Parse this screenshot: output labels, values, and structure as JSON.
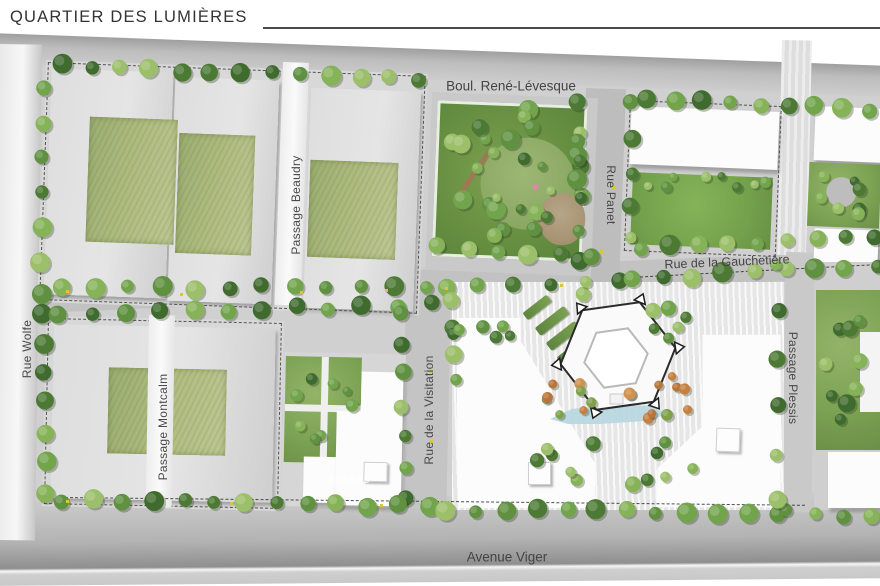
{
  "title": "QUARTIER DES LUMIÈRES",
  "map": {
    "streets": {
      "rene_levesque": {
        "label": "Boul. René-Lévesque"
      },
      "viger": {
        "label": "Avenue Viger"
      },
      "wolfe": {
        "label": "Rue Wolfe"
      },
      "panet": {
        "label": "Rue Panet"
      },
      "gauchetiere": {
        "label": "Rue de la Gauchetière"
      },
      "beaudry": {
        "label": "Passage Beaudry"
      },
      "montcalm": {
        "label": "Passage Montcalm"
      },
      "visitation": {
        "label": "Rue de la Visitation"
      },
      "plessis": {
        "label": "Passage Plessis"
      }
    },
    "building_note": "ÉTAGES",
    "colors": {
      "road_band": "#b0b0b0",
      "sidewalk": "#d0d0d0",
      "green_roof": "#aebb7f",
      "lawn": "#74a24c",
      "park": "#6f9449",
      "water": "#b9d8e1",
      "autumn_tree": "#c9853f",
      "building_white": "#fcfcfc",
      "label_text": "#4a4a4a"
    },
    "tree_palette_green": [
      "#4c7a35",
      "#5f9140",
      "#72a44c",
      "#86b258",
      "#3f6b2e",
      "#9cbf6a"
    ],
    "tree_palette_orange": [
      "#c5803f",
      "#d1924f",
      "#b9743a",
      "#7fa14c"
    ],
    "tree_rows": [
      {
        "x1": 60,
        "y1": 66,
        "x2": 420,
        "y2": 80,
        "n": 13,
        "r": 8,
        "p": "g"
      },
      {
        "x1": 42,
        "y1": 88,
        "x2": 42,
        "y2": 295,
        "n": 7,
        "r": 8,
        "p": "g"
      },
      {
        "x1": 44,
        "y1": 312,
        "x2": 46,
        "y2": 492,
        "n": 7,
        "r": 8,
        "p": "g"
      },
      {
        "x1": 578,
        "y1": 102,
        "x2": 582,
        "y2": 292,
        "n": 7,
        "r": 7,
        "p": "g"
      },
      {
        "x1": 630,
        "y1": 104,
        "x2": 632,
        "y2": 240,
        "n": 5,
        "r": 7,
        "p": "g"
      },
      {
        "x1": 648,
        "y1": 100,
        "x2": 872,
        "y2": 110,
        "n": 9,
        "r": 8,
        "p": "g"
      },
      {
        "x1": 62,
        "y1": 289,
        "x2": 428,
        "y2": 286,
        "n": 12,
        "r": 8,
        "p": "g"
      },
      {
        "x1": 60,
        "y1": 313,
        "x2": 430,
        "y2": 305,
        "n": 12,
        "r": 8,
        "p": "g"
      },
      {
        "x1": 445,
        "y1": 288,
        "x2": 618,
        "y2": 282,
        "n": 6,
        "r": 7,
        "p": "g"
      },
      {
        "x1": 640,
        "y1": 248,
        "x2": 876,
        "y2": 237,
        "n": 9,
        "r": 8,
        "p": "g"
      },
      {
        "x1": 632,
        "y1": 280,
        "x2": 876,
        "y2": 265,
        "n": 9,
        "r": 8,
        "p": "g"
      },
      {
        "x1": 402,
        "y1": 312,
        "x2": 404,
        "y2": 498,
        "n": 7,
        "r": 7,
        "p": "g"
      },
      {
        "x1": 453,
        "y1": 300,
        "x2": 455,
        "y2": 380,
        "n": 4,
        "r": 7,
        "p": "g"
      },
      {
        "x1": 62,
        "y1": 500,
        "x2": 428,
        "y2": 506,
        "n": 13,
        "r": 8,
        "p": "g"
      },
      {
        "x1": 446,
        "y1": 509,
        "x2": 778,
        "y2": 514,
        "n": 12,
        "r": 8,
        "p": "g"
      },
      {
        "x1": 788,
        "y1": 512,
        "x2": 872,
        "y2": 516,
        "n": 4,
        "r": 7,
        "p": "g"
      },
      {
        "x1": 777,
        "y1": 265,
        "x2": 778,
        "y2": 500,
        "n": 6,
        "r": 7,
        "p": "g"
      },
      {
        "x1": 436,
        "y1": 247,
        "x2": 592,
        "y2": 256,
        "n": 6,
        "r": 8,
        "p": "g"
      }
    ],
    "tree_clusters": [
      {
        "cx": 516,
        "cy": 176,
        "rx": 70,
        "ry": 66,
        "n": 22,
        "rmin": 5,
        "rmax": 10,
        "p": "g"
      },
      {
        "cx": 520,
        "cy": 180,
        "rx": 40,
        "ry": 38,
        "n": 6,
        "rmin": 4,
        "rmax": 7,
        "p": "g"
      },
      {
        "cx": 706,
        "cy": 182,
        "rx": 62,
        "ry": 9,
        "n": 8,
        "rmin": 4,
        "rmax": 6,
        "p": "g"
      },
      {
        "cx": 845,
        "cy": 195,
        "rx": 28,
        "ry": 26,
        "n": 7,
        "rmin": 4,
        "rmax": 7,
        "p": "g"
      },
      {
        "cx": 488,
        "cy": 332,
        "rx": 34,
        "ry": 8,
        "n": 6,
        "rmin": 5,
        "rmax": 8,
        "p": "g"
      },
      {
        "cx": 568,
        "cy": 398,
        "rx": 26,
        "ry": 18,
        "n": 8,
        "rmin": 4,
        "rmax": 6,
        "p": "o"
      },
      {
        "cx": 664,
        "cy": 398,
        "rx": 38,
        "ry": 24,
        "n": 10,
        "rmin": 4,
        "rmax": 6,
        "p": "o"
      },
      {
        "cx": 620,
        "cy": 462,
        "rx": 85,
        "ry": 26,
        "n": 12,
        "rmin": 5,
        "rmax": 8,
        "p": "g"
      },
      {
        "cx": 668,
        "cy": 322,
        "rx": 22,
        "ry": 16,
        "n": 6,
        "rmin": 5,
        "rmax": 8,
        "p": "g"
      },
      {
        "cx": 845,
        "cy": 360,
        "rx": 26,
        "ry": 58,
        "n": 9,
        "rmin": 5,
        "rmax": 9,
        "p": "g"
      },
      {
        "cx": 320,
        "cy": 405,
        "rx": 32,
        "ry": 40,
        "n": 8,
        "rmin": 4,
        "rmax": 7,
        "p": "g"
      }
    ],
    "lamps": [
      [
        66,
        290
      ],
      [
        180,
        293
      ],
      [
        300,
        291
      ],
      [
        385,
        289
      ],
      [
        445,
        287
      ],
      [
        560,
        284
      ],
      [
        66,
        500
      ],
      [
        230,
        502
      ],
      [
        380,
        504
      ],
      [
        612,
        186
      ],
      [
        600,
        250
      ],
      [
        430,
        370
      ],
      [
        430,
        440
      ]
    ],
    "hexagon": {
      "cx": 618,
      "cy": 356,
      "R": 58,
      "r": 32,
      "rot": -8
    },
    "water_poly": [
      [
        550,
        419
      ],
      [
        572,
        409
      ],
      [
        612,
        404
      ],
      [
        650,
        406
      ],
      [
        668,
        414
      ],
      [
        645,
        421
      ],
      [
        600,
        424
      ],
      [
        568,
        424
      ]
    ]
  }
}
